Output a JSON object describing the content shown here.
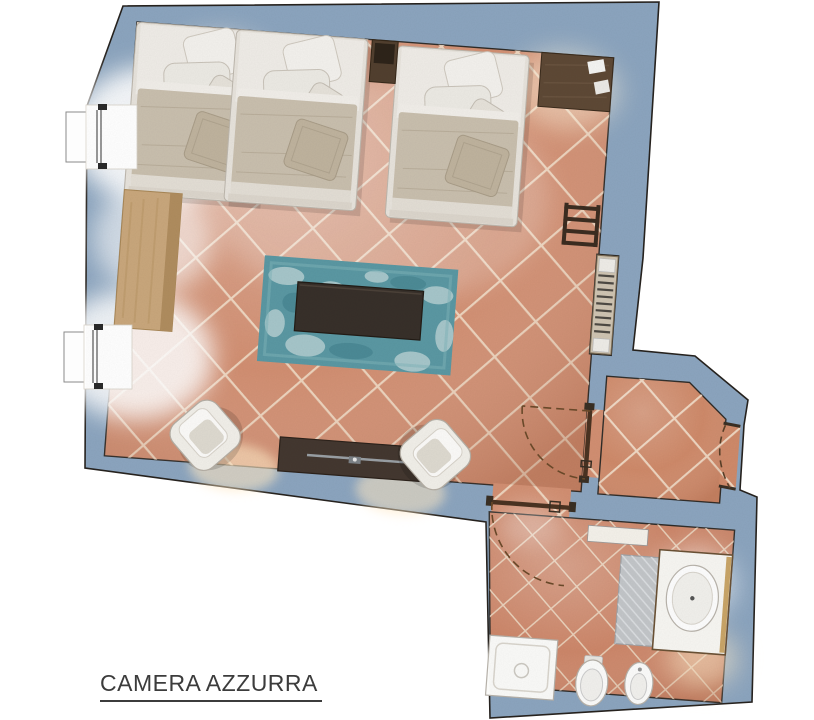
{
  "title": {
    "label": "CAMERA AZZURRA"
  },
  "palette": {
    "wall": "#8ca5bf",
    "outline": "#26221e",
    "floor_tile": "#d28f72",
    "grout": "#f0dcc6",
    "rug_teal": "#5b98a3",
    "dark_wood": "#4a382b",
    "light_wood": "#c9a77c",
    "white_fixture": "#f7f6f2",
    "warm_glow": "#ffe9c6"
  },
  "rooms": [
    {
      "name": "bedroom-living-area"
    },
    {
      "name": "vestibule"
    },
    {
      "name": "bathroom"
    }
  ],
  "furniture": [
    "double-bed",
    "double-bed",
    "nightstand",
    "wall-shelf",
    "desk",
    "sideboard",
    "teal-rug",
    "coffee-table",
    "armchair",
    "armchair",
    "tv-console",
    "towel-ladder",
    "radiator",
    "washbasin-vanity",
    "bath-mat",
    "shower-tray",
    "toilet",
    "bidet"
  ],
  "windows": 2,
  "door_swings": 3
}
